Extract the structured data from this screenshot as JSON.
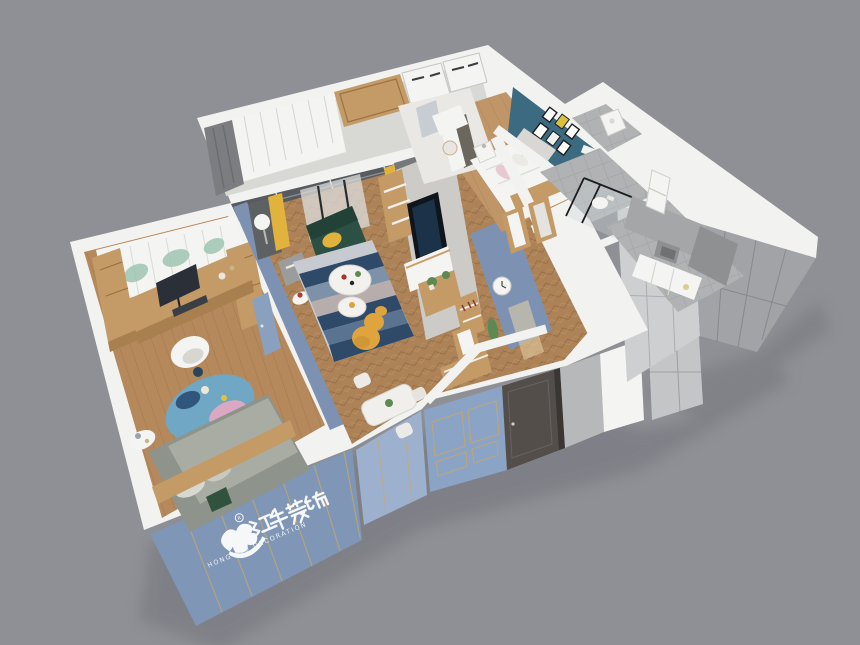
{
  "scene": {
    "kind": "3d-cutaway-floorplan-render",
    "view": "isometric top-down dollhouse view of a furnished apartment",
    "background_note": "flat grey studio backdrop"
  },
  "watermark": {
    "brand_cn": "红牛装饰",
    "brand_en": "HONG NIU DECORATION",
    "registered": "R"
  },
  "palette": {
    "background": "#8f9095",
    "wall_white": "#f2f2f0",
    "facade_blue": "#8ba3c4",
    "facade_blue_light": "#9db1ce",
    "gold_trim": "#c8a76c",
    "door_dark": "#544e4a",
    "tile_light": "#cdcfd1",
    "tile_mid": "#c3c5c7",
    "tile_dark": "#acaeb0",
    "grey_wall": "#b7b8ba",
    "teal_wall": "#3c6a80",
    "interior_blue": "#7d92b3",
    "wood": "#c49a66",
    "wood_dark": "#a87f4f",
    "plaster": "#cac8c4",
    "floor_wood": "#b5895c",
    "floor_herringbone": "#ad8257",
    "floor_master": "#c09668",
    "floor_tile": "#b0b2b4",
    "balcony_floor": "#d8d8d4",
    "armchair_green": "#2c5044",
    "accent_yellow": "#e2b33c",
    "sculpture_yellow": "#dfa43e",
    "rug_navy": "#2e4a68",
    "rug_slate": "#7d92a8",
    "rug_light": "#c7cbd1",
    "bedding_grey": "#8e938b",
    "pink": "#e8c9cf",
    "leaf_green": "#9ec4b0",
    "plant_green": "#5d8a52",
    "curtain_dark": "#5e6164",
    "white": "#f4f4f2"
  },
  "rooms": [
    {
      "id": "kids-bedroom",
      "items": [
        "leaf-print curtain",
        "wardrobe cabinets",
        "desk with monitor",
        "white chair",
        "round blue-pink rug",
        "bed with grey bedding"
      ]
    },
    {
      "id": "balcony",
      "items": [
        "sheer curtains",
        "white wardrobes",
        "wood panel"
      ]
    },
    {
      "id": "living-dining",
      "items": [
        "yellow and grey curtains",
        "green armchair with yellow pillow",
        "two round white coffee tables",
        "striped blue rug",
        "yellow gourd sculpture",
        "TV feature wall with shelving",
        "dining table with white chairs",
        "wall clock"
      ]
    },
    {
      "id": "master-bedroom",
      "items": [
        "teal gallery wall with picture frames",
        "white bed with pink pillow",
        "nightstand",
        "vanity desk with stool"
      ]
    },
    {
      "id": "bathroom",
      "items": [
        "glass shower with black frame",
        "toilet"
      ]
    },
    {
      "id": "kitchen",
      "items": [
        "fridge",
        "microwave",
        "white counters",
        "grey tiled walls"
      ]
    },
    {
      "id": "utility",
      "items": [
        "water heater appliance"
      ]
    }
  ]
}
